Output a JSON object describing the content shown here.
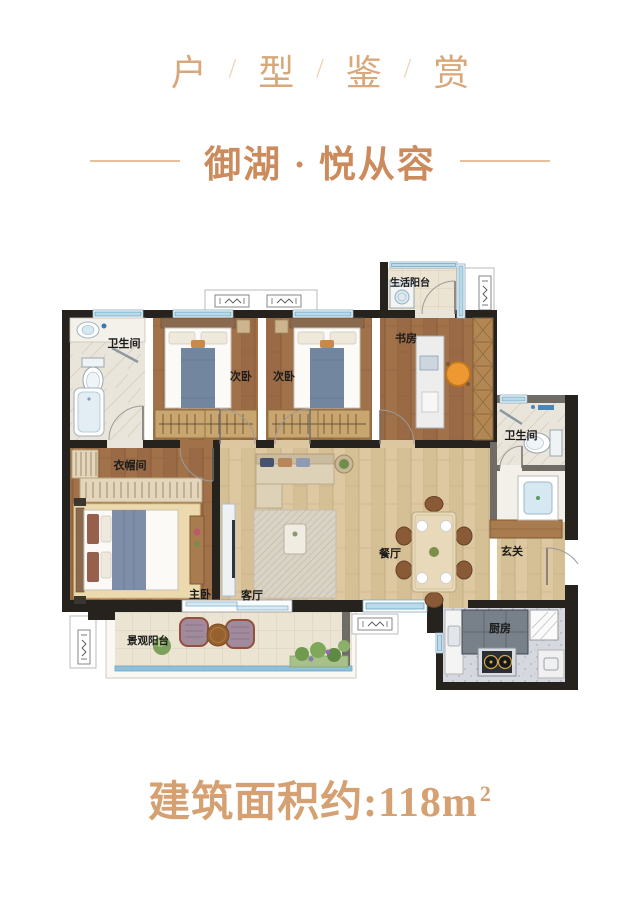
{
  "header": {
    "chars": [
      "户",
      "型",
      "鉴",
      "赏"
    ],
    "separator": "/"
  },
  "subtitle": {
    "text": "御湖 · 悦从容"
  },
  "plan": {
    "rooms": {
      "life_balcony": "生活阳台",
      "bath_top": "卫生间",
      "bed_left": "次卧",
      "bed_mid": "次卧",
      "study": "书房",
      "bath_right": "卫生间",
      "cloakroom": "衣帽间",
      "master": "主卧",
      "living": "客厅",
      "dining": "餐厅",
      "foyer": "玄关",
      "kitchen": "厨房",
      "view_balcony": "景观阳台"
    }
  },
  "footer": {
    "area_label": "建筑面积约:118m",
    "area_sup": "2"
  },
  "colors": {
    "title_accent": "#d9a87a",
    "subtitle_accent": "#cb8b5c",
    "area_accent": "#d5a173",
    "wall": "#26231f",
    "window_blue": "#5ea3c4"
  }
}
